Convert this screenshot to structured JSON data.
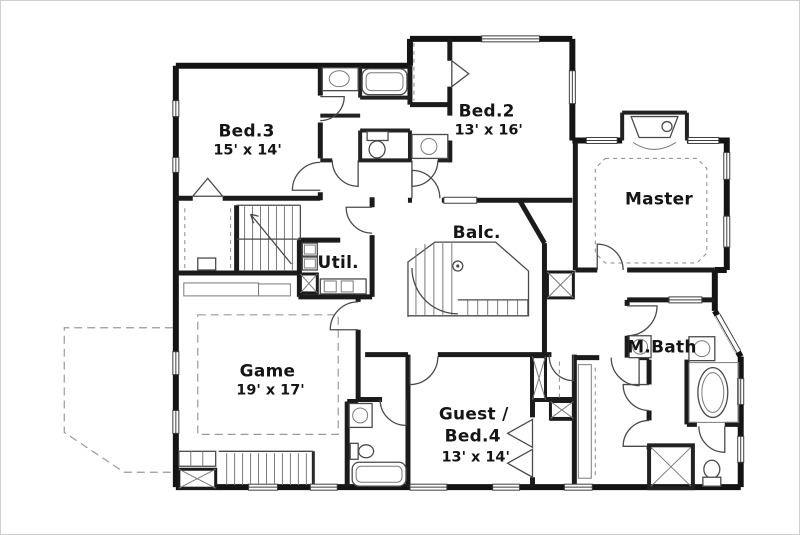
{
  "plan": {
    "kind": "residential-second-floor-plan",
    "colors": {
      "wall": "#141414",
      "thin_line": "#4a4a4a",
      "dashed_line": "#9a9a9a",
      "text": "#151515",
      "background": "#ffffff",
      "frame_border": "#cfcfcf"
    }
  },
  "rooms": {
    "bed3": {
      "name": "Bed.3",
      "dims": "15' x 14'"
    },
    "bed2": {
      "name": "Bed.2",
      "dims": "13' x 16'"
    },
    "master": {
      "name": "Master"
    },
    "balcony": {
      "name": "Balc."
    },
    "utility": {
      "name": "Util."
    },
    "game": {
      "name": "Game",
      "dims": "19' x 17'"
    },
    "guest": {
      "line1": "Guest /",
      "line2": "Bed.4",
      "dims": "13' x 14'"
    },
    "mbath": {
      "name": "M.Bath"
    }
  }
}
